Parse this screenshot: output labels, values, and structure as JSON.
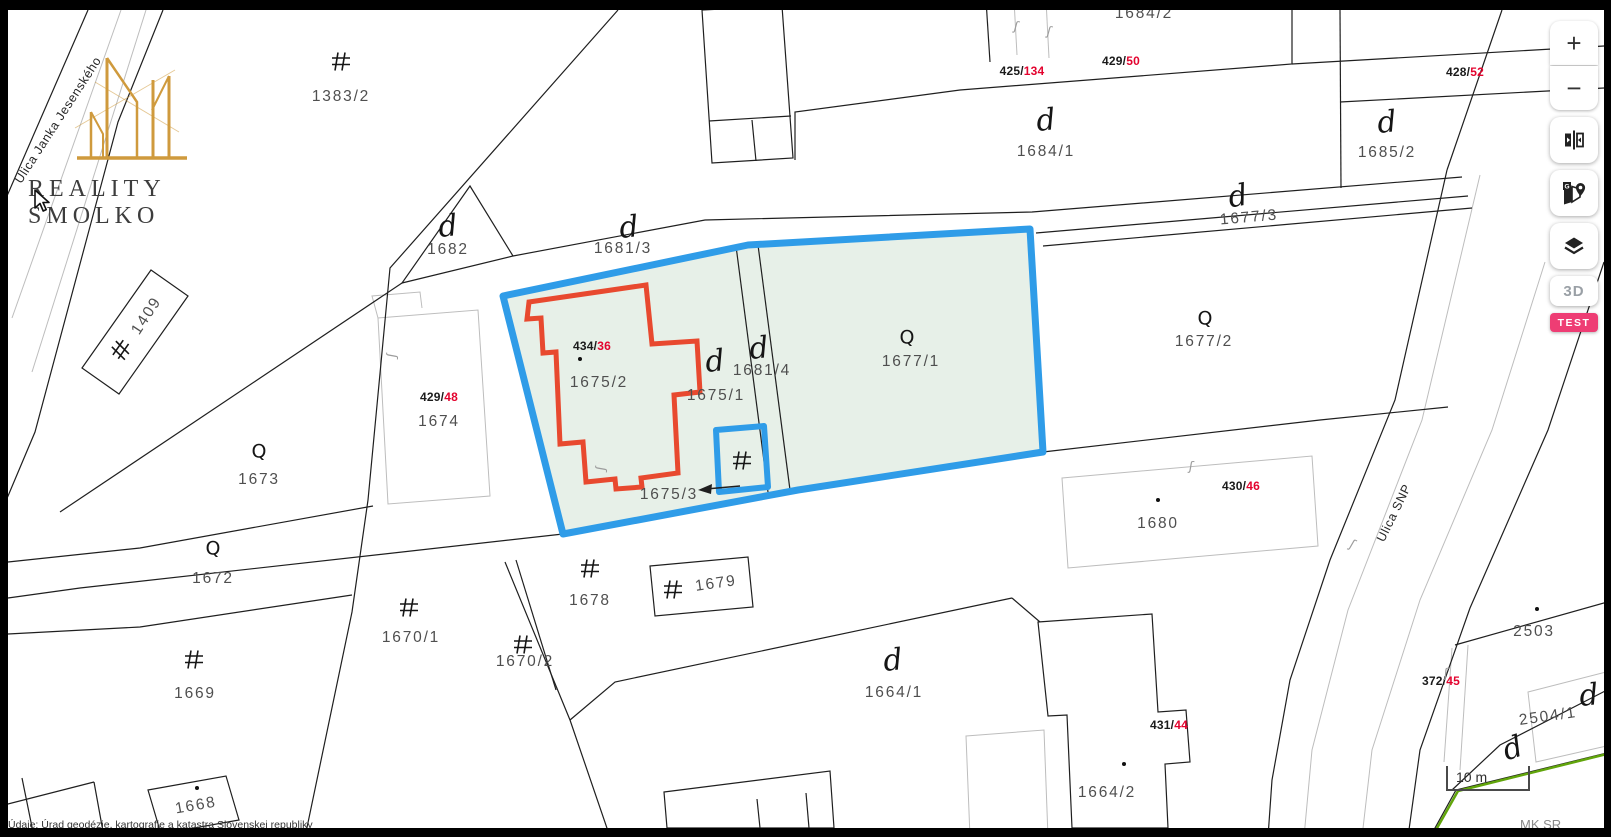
{
  "brand": {
    "name": "REALITY SMOLKO"
  },
  "controls": {
    "zoom_in": "+",
    "zoom_out": "−",
    "view_3d": "3D",
    "test_badge": "TEST"
  },
  "scalebar": {
    "label": "10 m"
  },
  "attribution": {
    "left": "Údaje: Úrad geodézie, kartografie a katastra Slovenskej republiky",
    "right": "MK SR"
  },
  "glyphs": {
    "courtyard": "d",
    "garden": "Q",
    "tie": "ʃ",
    "maps_g": "G"
  },
  "colors": {
    "selection_blue": "#2f9ce8",
    "selection_fill": "#e7f0e8",
    "building_red": "#e8492f",
    "code_red": "#e3032e",
    "cadastre_green": "#61a50b",
    "brand_gold": "#cf9a3d",
    "test_badge_pink": "#ee3d74"
  },
  "streets": [
    {
      "name": "Ulica Janka Jesenského",
      "x": 58,
      "y": 120,
      "rot": -57
    },
    {
      "name": "Ulica SNP",
      "x": 1394,
      "y": 513,
      "rot": -64
    }
  ],
  "parcels": [
    {
      "t": "1383/2",
      "x": 341,
      "y": 97,
      "rot": 0
    },
    {
      "t": "1684/2",
      "x": 1144,
      "y": 14,
      "rot": 0
    },
    {
      "t": "1684/1",
      "x": 1046,
      "y": 152,
      "rot": 0
    },
    {
      "t": "1685/2",
      "x": 1387,
      "y": 153,
      "rot": 0
    },
    {
      "t": "1677/3",
      "x": 1249,
      "y": 218,
      "rot": -5
    },
    {
      "t": "1682",
      "x": 448,
      "y": 250,
      "rot": 0
    },
    {
      "t": "1681/3",
      "x": 623,
      "y": 249,
      "rot": 0
    },
    {
      "t": "1409",
      "x": 147,
      "y": 316,
      "rot": -57
    },
    {
      "t": "1675/2",
      "x": 599,
      "y": 383,
      "rot": 0
    },
    {
      "t": "1675/1",
      "x": 716,
      "y": 396,
      "rot": 0
    },
    {
      "t": "1681/4",
      "x": 762,
      "y": 371,
      "rot": 0
    },
    {
      "t": "1677/1",
      "x": 911,
      "y": 362,
      "rot": 0
    },
    {
      "t": "1677/2",
      "x": 1204,
      "y": 342,
      "rot": 0
    },
    {
      "t": "1674",
      "x": 439,
      "y": 422,
      "rot": 0
    },
    {
      "t": "1673",
      "x": 259,
      "y": 480,
      "rot": 0
    },
    {
      "t": "1675/3",
      "x": 669,
      "y": 495,
      "rot": 0
    },
    {
      "t": "1680",
      "x": 1158,
      "y": 524,
      "rot": 0
    },
    {
      "t": "1672",
      "x": 213,
      "y": 579,
      "rot": 0
    },
    {
      "t": "1678",
      "x": 590,
      "y": 601,
      "rot": 0
    },
    {
      "t": "1679",
      "x": 716,
      "y": 584,
      "rot": -8
    },
    {
      "t": "1670/1",
      "x": 411,
      "y": 638,
      "rot": 0
    },
    {
      "t": "1670/2",
      "x": 525,
      "y": 662,
      "rot": 0
    },
    {
      "t": "1669",
      "x": 195,
      "y": 694,
      "rot": 0
    },
    {
      "t": "1664/1",
      "x": 894,
      "y": 693,
      "rot": 0
    },
    {
      "t": "2503",
      "x": 1534,
      "y": 632,
      "rot": 0
    },
    {
      "t": "2504/1",
      "x": 1548,
      "y": 717,
      "rot": -8
    },
    {
      "t": "1664/2",
      "x": 1107,
      "y": 793,
      "rot": 0
    },
    {
      "t": "1668",
      "x": 196,
      "y": 806,
      "rot": -10
    }
  ],
  "codes": [
    {
      "pre": "425/",
      "num": "134",
      "x": 1022,
      "y": 71
    },
    {
      "pre": "429/",
      "num": "50",
      "x": 1121,
      "y": 61
    },
    {
      "pre": "428/",
      "num": "52",
      "x": 1465,
      "y": 72
    },
    {
      "pre": "434/",
      "num": "36",
      "x": 592,
      "y": 346
    },
    {
      "pre": "429/",
      "num": "48",
      "x": 439,
      "y": 397
    },
    {
      "pre": "430/",
      "num": "46",
      "x": 1241,
      "y": 486
    },
    {
      "pre": "372/",
      "num": "45",
      "x": 1441,
      "y": 681
    },
    {
      "pre": "431/",
      "num": "44",
      "x": 1169,
      "y": 725
    }
  ],
  "symbols": {
    "d": [
      {
        "x": 448,
        "y": 227
      },
      {
        "x": 629,
        "y": 228
      },
      {
        "x": 715,
        "y": 362
      },
      {
        "x": 759,
        "y": 349
      },
      {
        "x": 1238,
        "y": 197,
        "rot": -10
      },
      {
        "x": 1046,
        "y": 121
      },
      {
        "x": 1387,
        "y": 123
      },
      {
        "x": 893,
        "y": 661
      },
      {
        "x": 1589,
        "y": 696
      },
      {
        "x": 1513,
        "y": 749,
        "rot": -18
      }
    ],
    "q": [
      {
        "x": 907,
        "y": 338
      },
      {
        "x": 1205,
        "y": 319
      },
      {
        "x": 259,
        "y": 452
      },
      {
        "x": 213,
        "y": 549
      }
    ],
    "building": [
      {
        "x": 341,
        "y": 64
      },
      {
        "x": 123,
        "y": 351,
        "rot": -55
      },
      {
        "x": 742,
        "y": 463
      },
      {
        "x": 590,
        "y": 571
      },
      {
        "x": 673,
        "y": 592
      },
      {
        "x": 409,
        "y": 610
      },
      {
        "x": 523,
        "y": 647
      },
      {
        "x": 194,
        "y": 662
      }
    ],
    "dots": [
      {
        "x": 580,
        "y": 359
      },
      {
        "x": 1158,
        "y": 500
      },
      {
        "x": 1537,
        "y": 609
      },
      {
        "x": 1124,
        "y": 764
      },
      {
        "x": 197,
        "y": 788
      }
    ],
    "ties": [
      {
        "x": 392,
        "y": 356,
        "rot": 100
      },
      {
        "x": 601,
        "y": 469,
        "rot": 100
      },
      {
        "x": 1016,
        "y": 27,
        "rot": 15
      },
      {
        "x": 1049,
        "y": 32,
        "rot": 15
      },
      {
        "x": 1191,
        "y": 467,
        "rot": 10
      },
      {
        "x": 1352,
        "y": 545,
        "rot": 30
      },
      {
        "x": 1446,
        "y": 674,
        "rot": 5
      }
    ]
  }
}
